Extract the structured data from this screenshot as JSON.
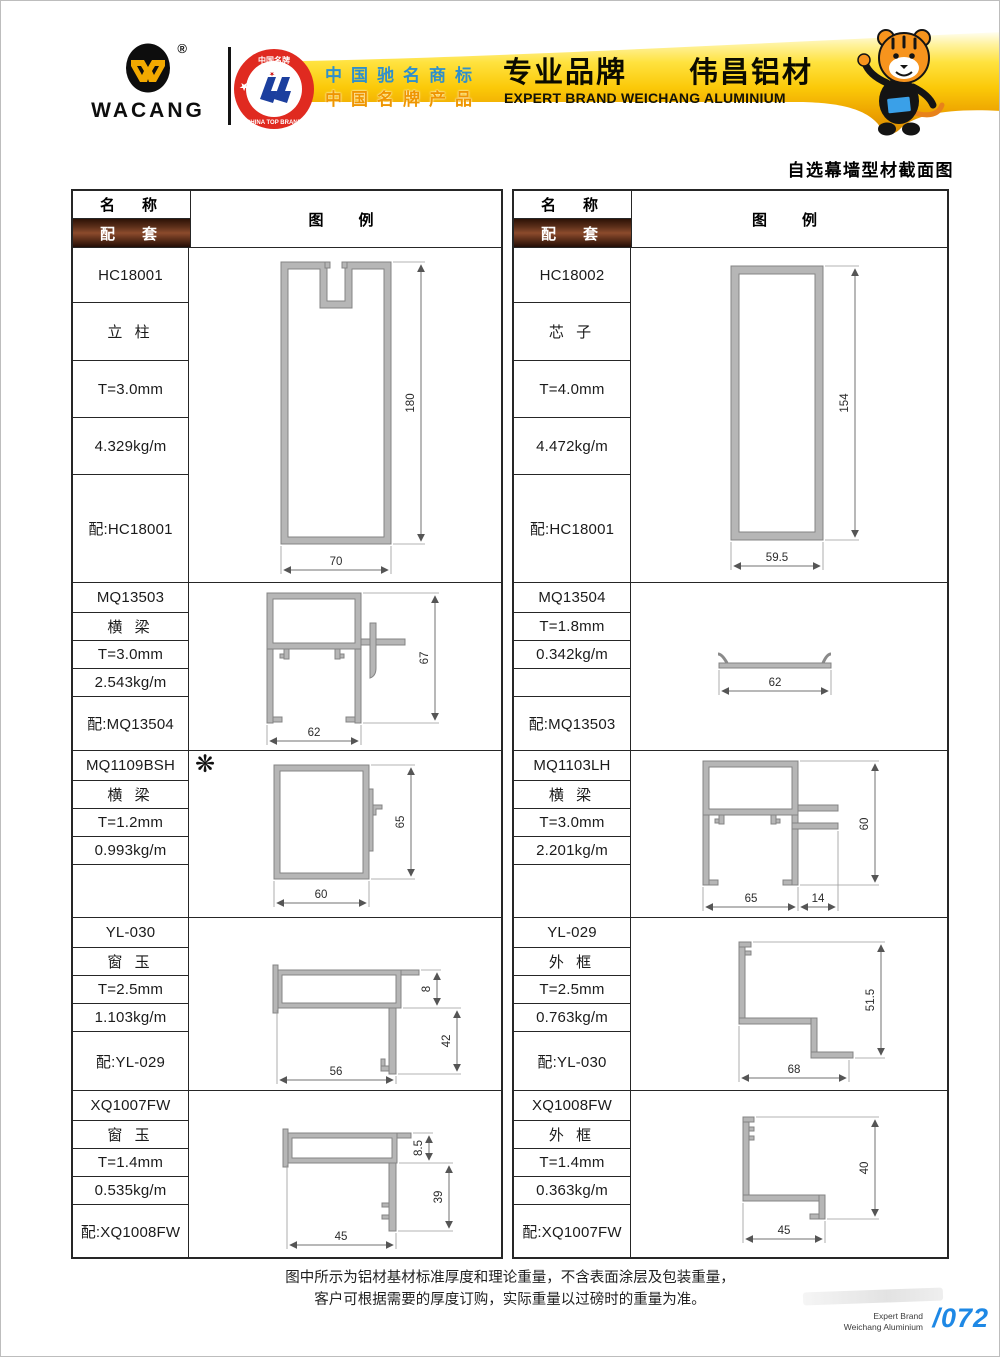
{
  "header": {
    "brand": "WACANG",
    "registered": "®",
    "badge": {
      "top_text": "中国名牌",
      "bottom_text": "CHINA TOP BRAND"
    },
    "banner": {
      "line1": "中国驰名商标",
      "line2": "中国名牌产品",
      "title": "专业品牌　　伟昌铝材",
      "subtitle": "EXPERT BRAND WEICHANG ALUMINIUM"
    }
  },
  "page_title": "自选幕墙型材截面图",
  "table_headers": {
    "name": "名　称",
    "match": "配　套",
    "example": "图　例"
  },
  "star": "❋",
  "rows": [
    {
      "left": {
        "cells": [
          "HC18001",
          "立 柱",
          "T=3.0mm",
          "4.329kg/m",
          "配:HC18001"
        ],
        "dims": {
          "width": "70",
          "height": "180"
        }
      },
      "right": {
        "cells": [
          "HC18002",
          "芯 子",
          "T=4.0mm",
          "4.472kg/m",
          "配:HC18001"
        ],
        "dims": {
          "width": "59.5",
          "height": "154"
        }
      }
    },
    {
      "left": {
        "cells": [
          "MQ13503",
          "横 梁",
          "T=3.0mm",
          "2.543kg/m",
          "配:MQ13504"
        ],
        "dims": {
          "width": "62",
          "height": "67"
        }
      },
      "right": {
        "cells": [
          "MQ13504",
          "T=1.8mm",
          "0.342kg/m",
          "",
          "配:MQ13503"
        ],
        "dims": {
          "width": "62"
        }
      }
    },
    {
      "left": {
        "cells": [
          "MQ1109BSH",
          "横 梁",
          "T=1.2mm",
          "0.993kg/m",
          ""
        ],
        "dims": {
          "width": "60",
          "height": "65"
        }
      },
      "right": {
        "cells": [
          "MQ1103LH",
          "横 梁",
          "T=3.0mm",
          "2.201kg/m",
          ""
        ],
        "dims": {
          "width": "65",
          "height": "60",
          "offset": "14"
        }
      }
    },
    {
      "left": {
        "cells": [
          "YL-030",
          "窗 玉",
          "T=2.5mm",
          "1.103kg/m",
          "配:YL-029"
        ],
        "dims": {
          "width": "56",
          "height": "42",
          "top": "8"
        }
      },
      "right": {
        "cells": [
          "YL-029",
          "外 框",
          "T=2.5mm",
          "0.763kg/m",
          "配:YL-030"
        ],
        "dims": {
          "width": "68",
          "height": "51.5"
        }
      }
    },
    {
      "left": {
        "cells": [
          "XQ1007FW",
          "窗 玉",
          "T=1.4mm",
          "0.535kg/m",
          "配:XQ1008FW"
        ],
        "dims": {
          "width": "45",
          "height": "39",
          "top": "8.5"
        }
      },
      "right": {
        "cells": [
          "XQ1008FW",
          "外 框",
          "T=1.4mm",
          "0.363kg/m",
          "配:XQ1007FW"
        ],
        "dims": {
          "width": "45",
          "height": "40"
        }
      }
    }
  ],
  "footnote": {
    "line1": "图中所示为铝材基材标准厚度和理论重量，不含表面涂层及包装重量，",
    "line2": "客户可根据需要的厚度订购，实际重量以过磅时的重量为准。"
  },
  "footer": {
    "brand_line1": "Expert Brand",
    "brand_line2": "Weichang Aluminium",
    "page_number": "/072"
  }
}
